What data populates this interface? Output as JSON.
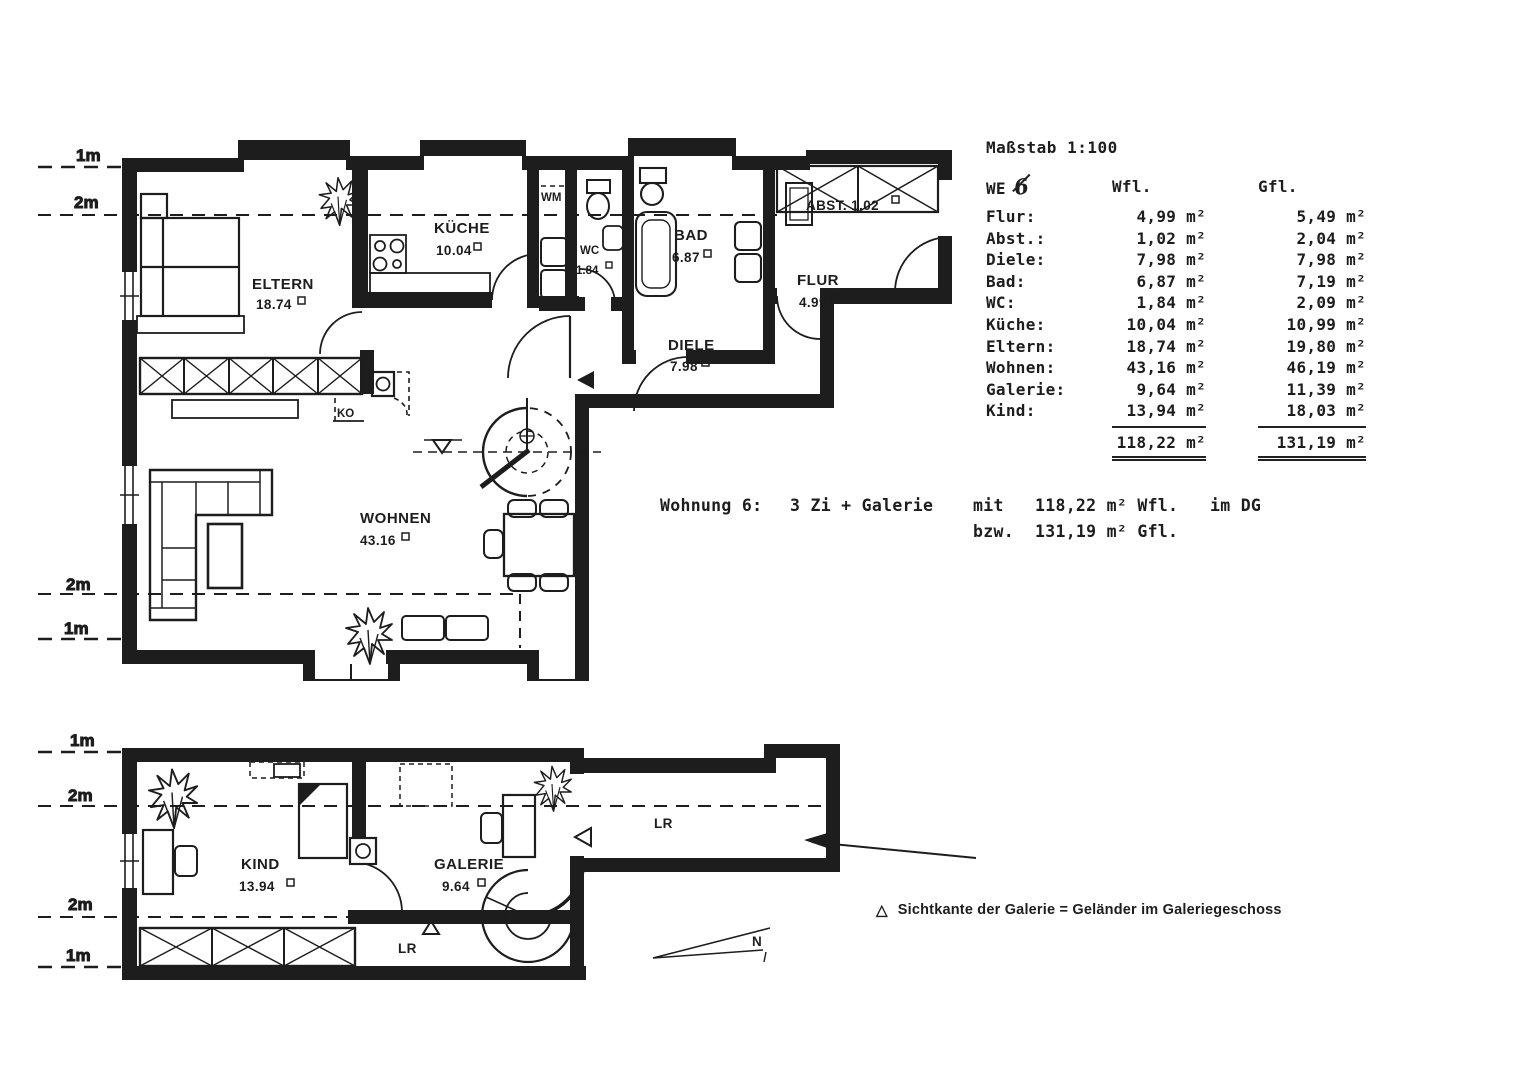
{
  "scale_label": "Maßstab 1:100",
  "area_table": {
    "header": {
      "we": "WE",
      "we_number": "6",
      "wfl": "Wfl.",
      "gfl": "Gfl."
    },
    "rows": [
      {
        "label": "Flur:",
        "wfl": "4,99 m²",
        "gfl": "5,49 m²"
      },
      {
        "label": "Abst.:",
        "wfl": "1,02 m²",
        "gfl": "2,04 m²"
      },
      {
        "label": "Diele:",
        "wfl": "7,98 m²",
        "gfl": "7,98 m²"
      },
      {
        "label": "Bad:",
        "wfl": "6,87 m²",
        "gfl": "7,19 m²"
      },
      {
        "label": "WC:",
        "wfl": "1,84 m²",
        "gfl": "2,09 m²"
      },
      {
        "label": "Küche:",
        "wfl": "10,04 m²",
        "gfl": "10,99 m²"
      },
      {
        "label": "Eltern:",
        "wfl": "18,74 m²",
        "gfl": "19,80 m²"
      },
      {
        "label": "Wohnen:",
        "wfl": "43,16 m²",
        "gfl": "46,19 m²"
      },
      {
        "label": "Galerie:",
        "wfl": "9,64 m²",
        "gfl": "11,39 m²"
      },
      {
        "label": "Kind:",
        "wfl": "13,94 m²",
        "gfl": "18,03 m²"
      }
    ],
    "totals": {
      "wfl": "118,22 m²",
      "gfl": "131,19 m²"
    }
  },
  "summary": {
    "title": "Wohnung 6:",
    "rooms": "3 Zi + Galerie",
    "mit": "mit",
    "wfl_value": "118,22 m² Wfl.",
    "location": "im DG",
    "bzw": "bzw.",
    "gfl_value": "131,19 m² Gfl."
  },
  "legend": {
    "symbol": "△",
    "text": "Sichtkante der Galerie = Geländer im Galeriegeschoss"
  },
  "north_label": "N",
  "upper_plan": {
    "height_marks": [
      "1m",
      "2m",
      "2m",
      "1m"
    ],
    "labels": {
      "eltern_name": "ELTERN",
      "eltern_area": "18.74",
      "kueche_name": "KÜCHE",
      "kueche_area": "10.04",
      "wm": "WM",
      "wc_name": "WC",
      "wc_area": "1.84",
      "bad_name": "BAD",
      "bad_area": "6.87",
      "flur_name": "FLUR",
      "flur_area": "4.99",
      "abst": "ABST. 1.02",
      "diele_name": "DIELE",
      "diele_area": "7.98",
      "wohnen_name": "WOHNEN",
      "wohnen_area": "43.16",
      "ko": "KO"
    }
  },
  "lower_plan": {
    "height_marks": [
      "1m",
      "2m",
      "2m",
      "1m"
    ],
    "labels": {
      "kind_name": "KIND",
      "kind_area": "13.94",
      "galerie_name": "GALERIE",
      "galerie_area": "9.64",
      "lr_void": "LR",
      "lr_corridor": "LR"
    }
  }
}
